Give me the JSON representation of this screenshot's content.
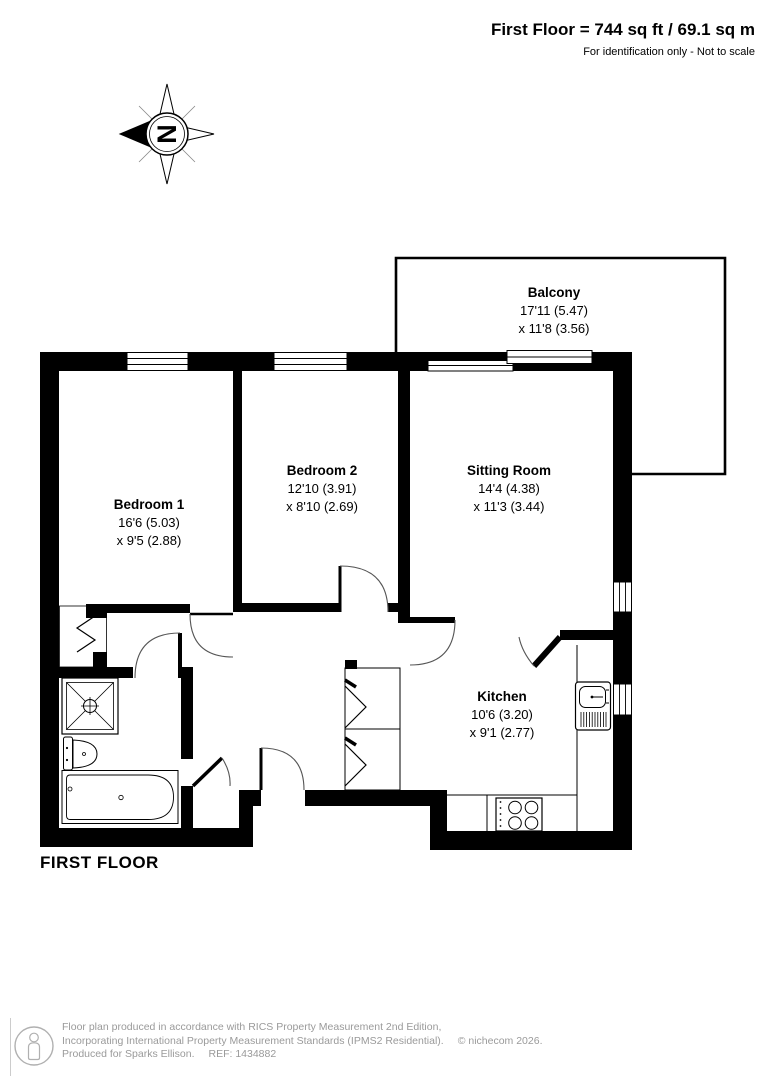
{
  "header": {
    "title": "First Floor = 744 sq ft / 69.1 sq m",
    "subtitle": "For identification only - Not to scale"
  },
  "compass": {
    "north_letter": "N"
  },
  "plan": {
    "floor_label": "FIRST FLOOR",
    "rooms": [
      {
        "name": "Balcony",
        "dims1": "17'11 (5.47)",
        "dims2": "x 11'8 (3.56)"
      },
      {
        "name": "Bedroom 1",
        "dims1": "16'6 (5.03)",
        "dims2": "x 9'5 (2.88)"
      },
      {
        "name": "Bedroom 2",
        "dims1": "12'10 (3.91)",
        "dims2": "x 8'10 (2.69)"
      },
      {
        "name": "Sitting Room",
        "dims1": "14'4 (4.38)",
        "dims2": "x 11'3 (3.44)"
      },
      {
        "name": "Kitchen",
        "dims1": "10'6 (3.20)",
        "dims2": "x 9'1 (2.77)"
      }
    ]
  },
  "footer": {
    "line1": "Floor plan produced in accordance with RICS Property Measurement 2nd Edition,",
    "line2": "Incorporating International Property Measurement Standards (IPMS2 Residential).",
    "copyright": "© nichecom 2026.",
    "produced_for": "Produced for Sparks Ellison.",
    "ref": "REF: 1434882"
  },
  "colors": {
    "wall": "#000000",
    "footer_text": "#9a9a9a"
  }
}
